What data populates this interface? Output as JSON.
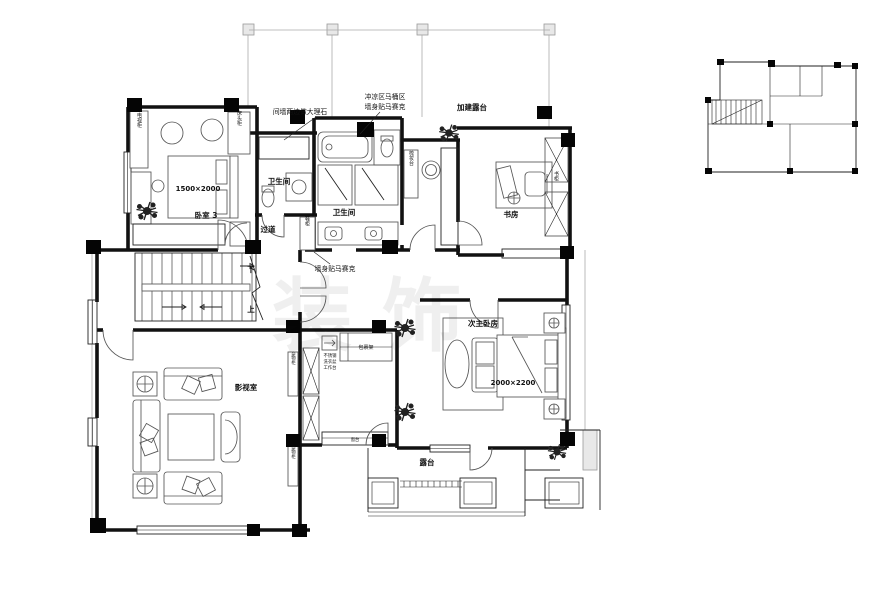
{
  "colors": {
    "wall": "#111111",
    "furniture_line": "#555555",
    "light_line": "#aaaaaa",
    "column_fill": "#050505",
    "background": "#ffffff"
  },
  "annotations": {
    "marble": "间墙两边做大理石",
    "wet_area_line1": "冲凉区马桶区",
    "wet_area_line2": "墙身贴马赛克",
    "added_terrace": "加建露台",
    "mosaic_wall": "墙身贴马赛克"
  },
  "rooms": {
    "bedroom3": "卧室 3",
    "bathroom1": "卫生间",
    "bathroom2": "卫生间",
    "corridor": "过道",
    "study": "书房",
    "media_room": "影视室",
    "master2": "次主卧房",
    "terrace": "露台"
  },
  "dimensions": {
    "bed3": "1500×2000",
    "master_bed": "2000×2200"
  },
  "fixtures": {
    "shoe_cabinet": "鞋柜",
    "dressing_table": "梳妆台",
    "bookcase": "书柜",
    "tv_cabinet": "电视柜",
    "bedside_cabinet": "床头柜",
    "package_rack": "包裹架",
    "cabinet_left_upper": "杂物柜",
    "cabinet_left_lower": "杂物柜",
    "laundry_note_1": "不锈钢",
    "laundry_note_2": "洗衣盆",
    "laundry_note_3": "工作台",
    "window_sill": "窗台"
  },
  "stairs": {
    "down": "下",
    "up": "上"
  },
  "watermark": {
    "text": "装饰"
  }
}
